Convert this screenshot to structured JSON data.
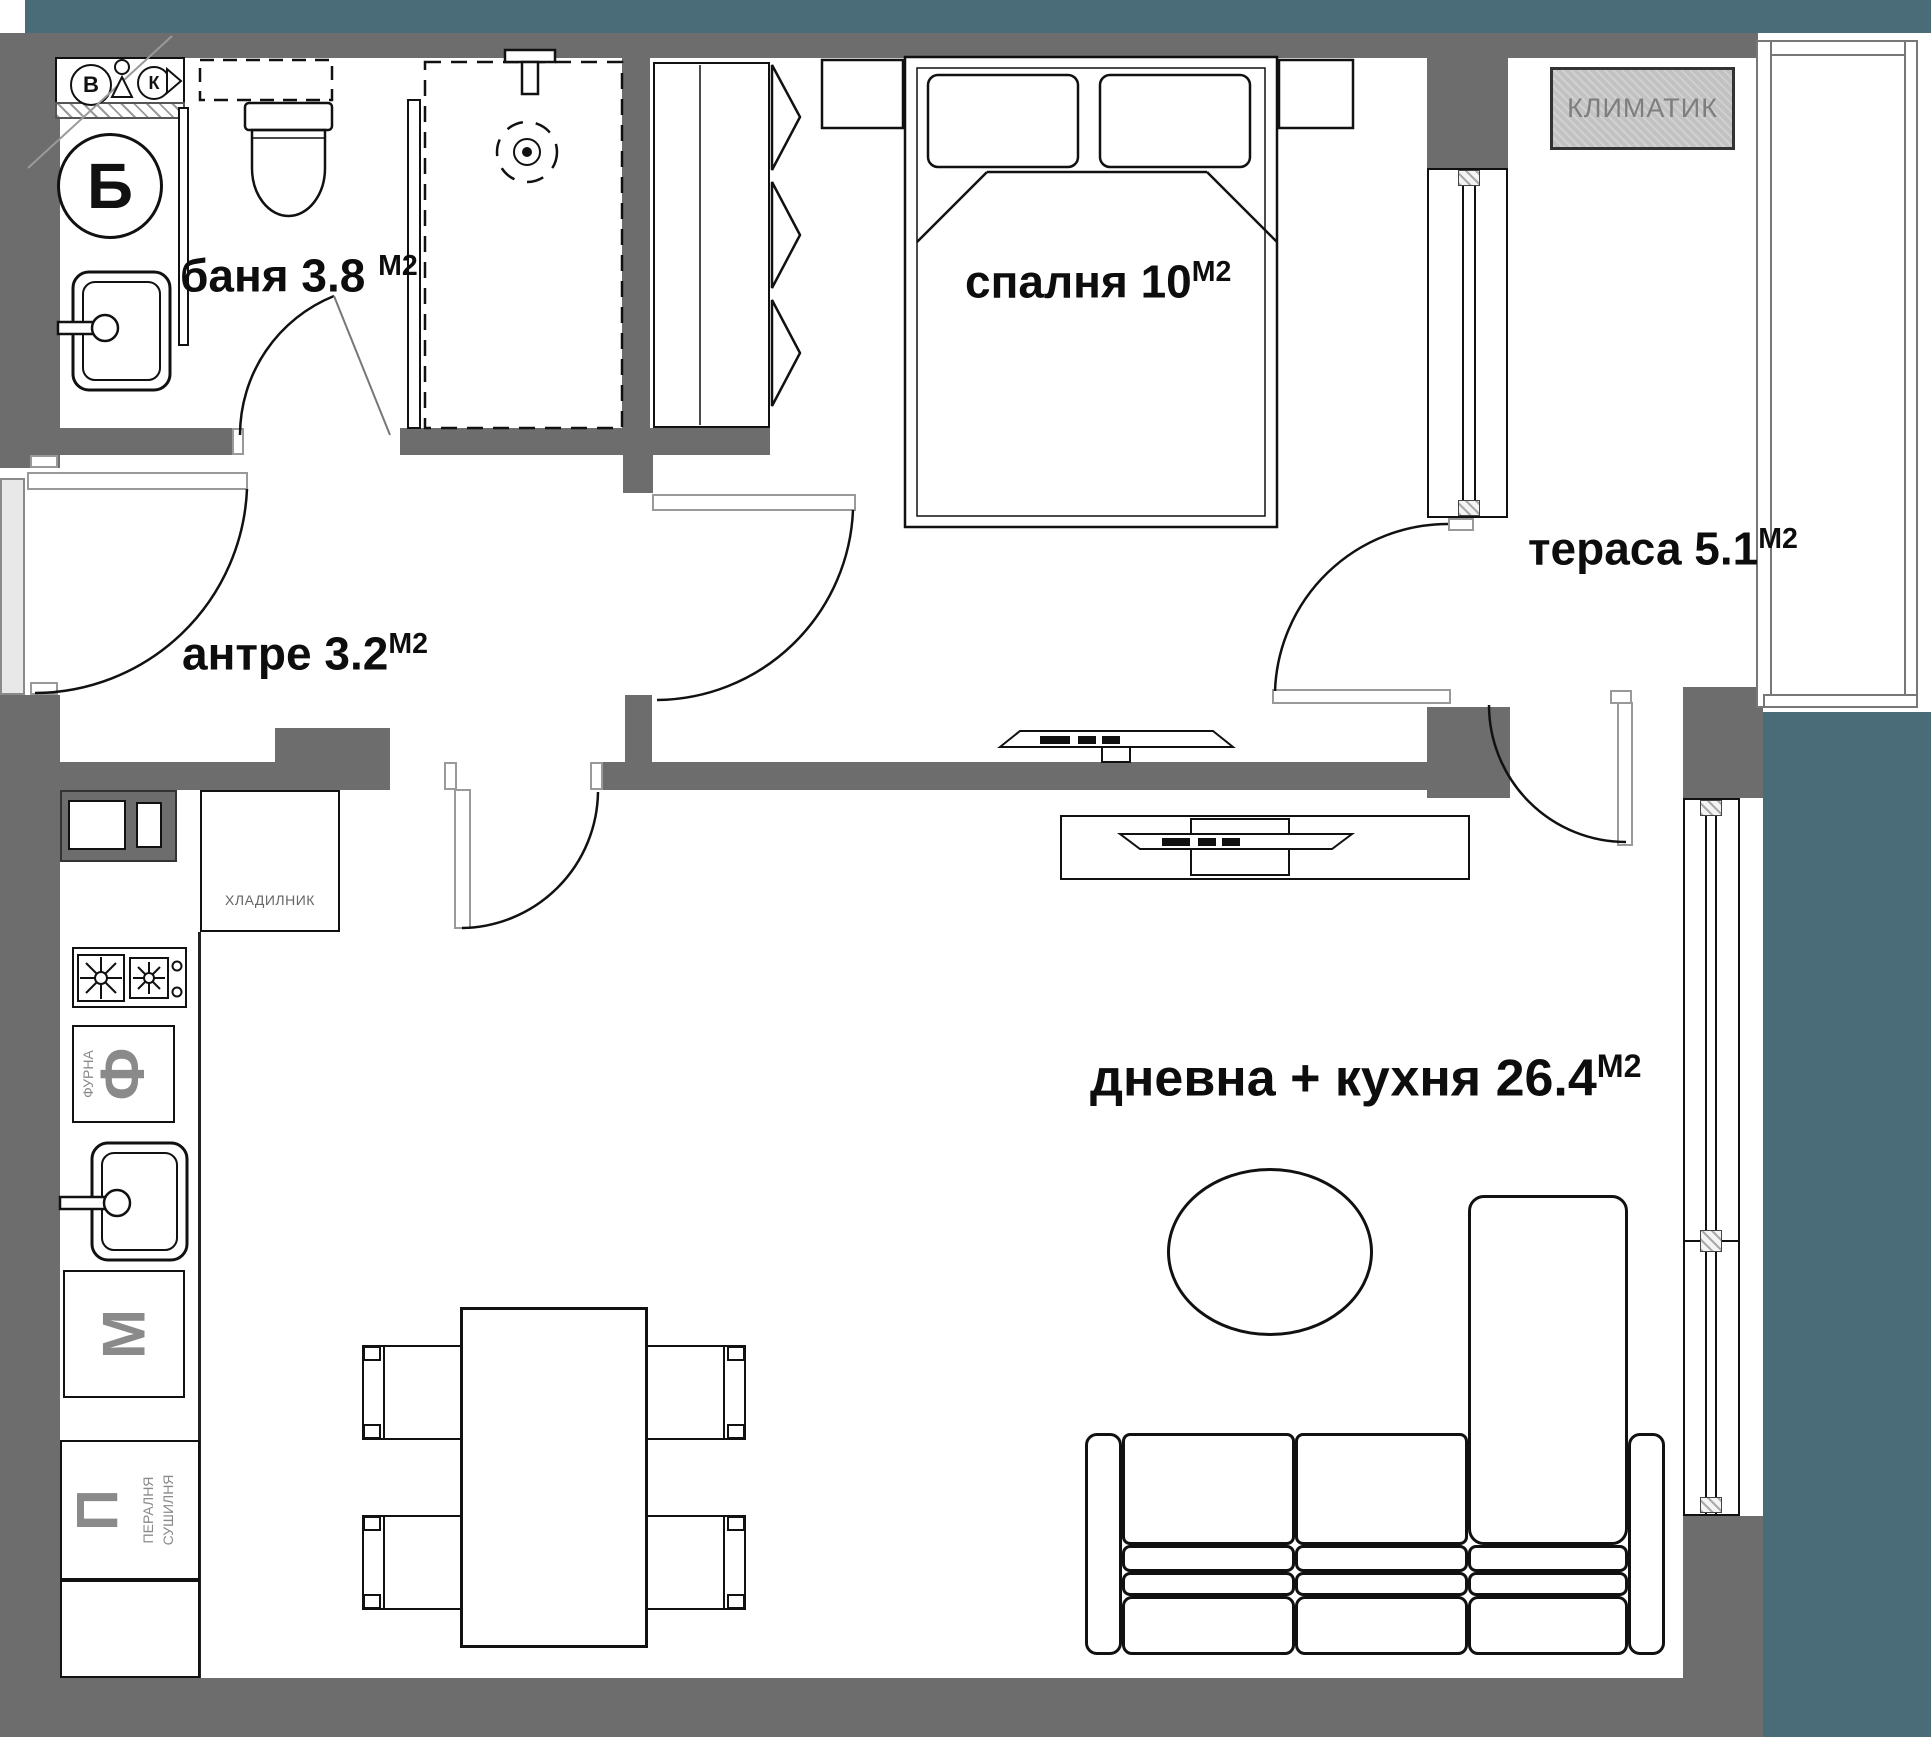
{
  "title": "apartment floor plan",
  "colors": {
    "outside_mass": "#4A6B78",
    "wall": "#6D6D6D",
    "line": "#111111",
    "muted_text": "#7E7E7E",
    "ac_fill": "#C2C2C2"
  },
  "rooms": {
    "bathroom": {
      "label": "баня 3.8",
      "unit": "М2"
    },
    "hall": {
      "label": "антре 3.2",
      "unit": "М2"
    },
    "bedroom": {
      "label": "спалня 10",
      "unit": "М2"
    },
    "terrace": {
      "label": "тераса 5.1",
      "unit": "М2"
    },
    "living": {
      "label": "дневна + кухня 26.4",
      "unit": "М2"
    }
  },
  "fixtures": {
    "ac": "КЛИМАТИК",
    "fridge": "ХЛАДИЛНИК",
    "oven_letter": "Ф",
    "oven_label": "ФУРНА",
    "appliance_m_letter": "М",
    "laundry_letter": "П",
    "laundry_line1": "ПЕРАЛНЯ",
    "laundry_line2": "СУШИЛНЯ",
    "boiler_letter": "Б",
    "shaft_letter_left": "В",
    "shaft_letter_right": "К"
  }
}
